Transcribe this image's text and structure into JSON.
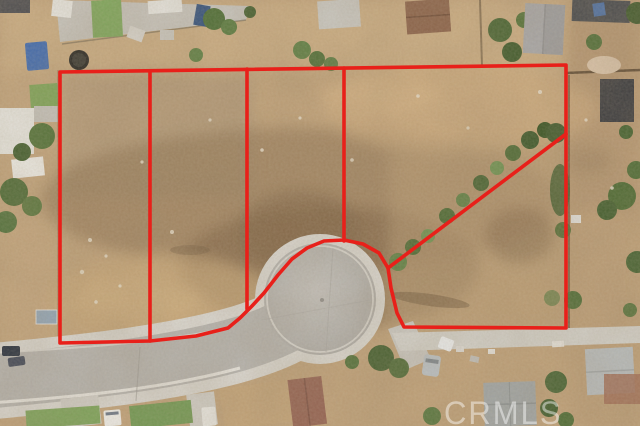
{
  "photo": {
    "description": "Aerial drone view of vacant dirt land lots outlined in red at the bulb of a residential cul-de-sac street",
    "width_px": 640,
    "height_px": 426
  },
  "watermark": {
    "text": "CRMLS",
    "color": "#ffffff",
    "opacity": 0.45
  },
  "boundary_overlay": {
    "color": "#e8201a",
    "line_width": 3.6,
    "shapes": [
      {
        "name": "parcel-outline",
        "closed": true,
        "points": [
          [
            60,
            72
          ],
          [
            566,
            65
          ],
          [
            566,
            328
          ],
          [
            404,
            327
          ],
          [
            397,
            313
          ],
          [
            391,
            288
          ],
          [
            388,
            268
          ],
          [
            379,
            253
          ],
          [
            363,
            244
          ],
          [
            344,
            240
          ],
          [
            324,
            241
          ],
          [
            307,
            248
          ],
          [
            292,
            259
          ],
          [
            278,
            275
          ],
          [
            264,
            293
          ],
          [
            252,
            306
          ],
          [
            240,
            318
          ],
          [
            228,
            328
          ],
          [
            196,
            336
          ],
          [
            150,
            341
          ],
          [
            60,
            343
          ]
        ]
      },
      {
        "name": "lot-divider-1",
        "closed": false,
        "points": [
          [
            150,
            71
          ],
          [
            150,
            341
          ]
        ]
      },
      {
        "name": "lot-divider-2",
        "closed": false,
        "points": [
          [
            247,
            69
          ],
          [
            247,
            309
          ]
        ]
      },
      {
        "name": "lot-divider-3",
        "closed": false,
        "points": [
          [
            344,
            68
          ],
          [
            344,
            241
          ]
        ]
      },
      {
        "name": "lot-divider-diagonal",
        "closed": false,
        "points": [
          [
            566,
            134
          ],
          [
            388,
            268
          ]
        ]
      }
    ]
  }
}
